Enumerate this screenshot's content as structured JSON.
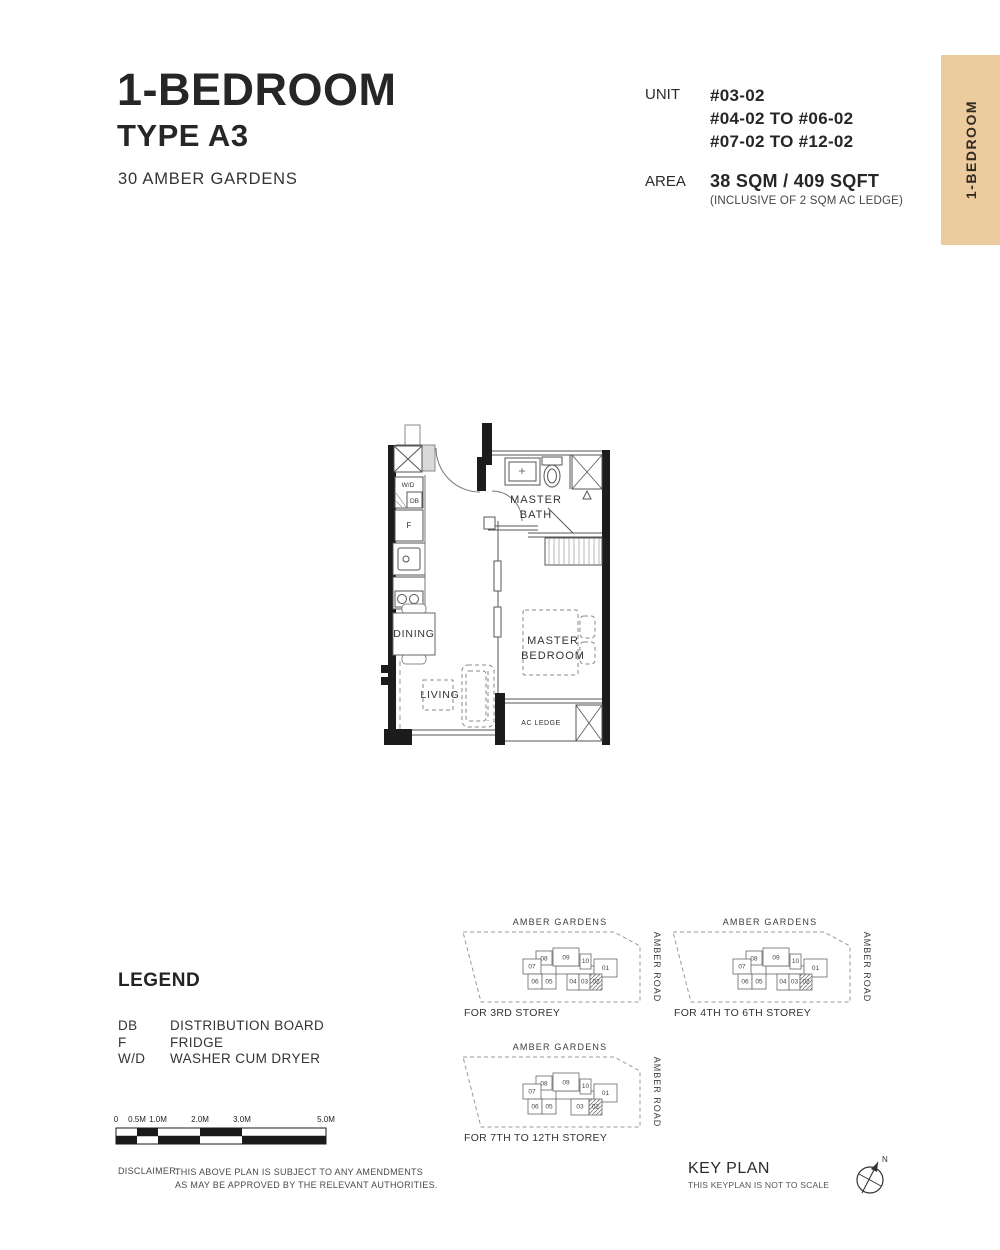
{
  "header": {
    "title": "1-BEDROOM",
    "subtitle": "TYPE A3",
    "project": "30 AMBER GARDENS",
    "unit_label": "UNIT",
    "unit_lines": [
      "#03-02",
      "#04-02 TO #06-02",
      "#07-02 TO #12-02"
    ],
    "area_label": "AREA",
    "area_value": "38 SQM / 409 SQFT",
    "area_note": "(INCLUSIVE OF 2 SQM AC LEDGE)"
  },
  "side_tab": {
    "label": "1-BEDROOM",
    "bg_color": "#ECCB9F"
  },
  "floor_plan": {
    "rooms": {
      "master_bath_line1": "MASTER",
      "master_bath_line2": "BATH",
      "dining": "DINING",
      "living": "LIVING",
      "master_bedroom_line1": "MASTER",
      "master_bedroom_line2": "BEDROOM",
      "ac_ledge": "AC LEDGE"
    },
    "fixtures": {
      "washer_dryer": "W/D",
      "distribution_board": "DB",
      "fridge": "F"
    }
  },
  "legend": {
    "title": "LEGEND",
    "items": [
      {
        "key": "DB",
        "value": "DISTRIBUTION BOARD"
      },
      {
        "key": "F",
        "value": "FRIDGE"
      },
      {
        "key": "W/D",
        "value": "WASHER CUM DRYER"
      }
    ]
  },
  "scale_bar": {
    "labels": [
      "0",
      "0.5M",
      "1.0M",
      "2.0M",
      "3.0M",
      "5.0M"
    ]
  },
  "disclaimer": {
    "label": "DISCLAIMER:",
    "line1": "THIS ABOVE PLAN IS SUBJECT TO ANY AMENDMENTS",
    "line2": "AS MAY BE APPROVED BY THE RELEVANT AUTHORITIES."
  },
  "keyplans": [
    {
      "street_top": "AMBER GARDENS",
      "street_right": "AMBER ROAD",
      "caption": "FOR 3RD STOREY",
      "units": [
        "08",
        "09",
        "10",
        "07",
        "01",
        "06",
        "05",
        "04",
        "03",
        "02"
      ],
      "highlighted_unit": "02"
    },
    {
      "street_top": "AMBER GARDENS",
      "street_right": "AMBER ROAD",
      "caption": "FOR 4TH TO 6TH STOREY",
      "units": [
        "08",
        "09",
        "10",
        "07",
        "01",
        "06",
        "05",
        "04",
        "03",
        "02"
      ],
      "highlighted_unit": "02"
    },
    {
      "street_top": "AMBER GARDENS",
      "street_right": "AMBER ROAD",
      "caption": "FOR 7TH TO 12TH STOREY",
      "units": [
        "08",
        "09",
        "10",
        "07",
        "01",
        "06",
        "05",
        "03",
        "02"
      ],
      "highlighted_unit": "02"
    }
  ],
  "key_plan_footer": {
    "title": "KEY PLAN",
    "note": "THIS KEYPLAN IS NOT TO SCALE",
    "compass_label": "N"
  }
}
